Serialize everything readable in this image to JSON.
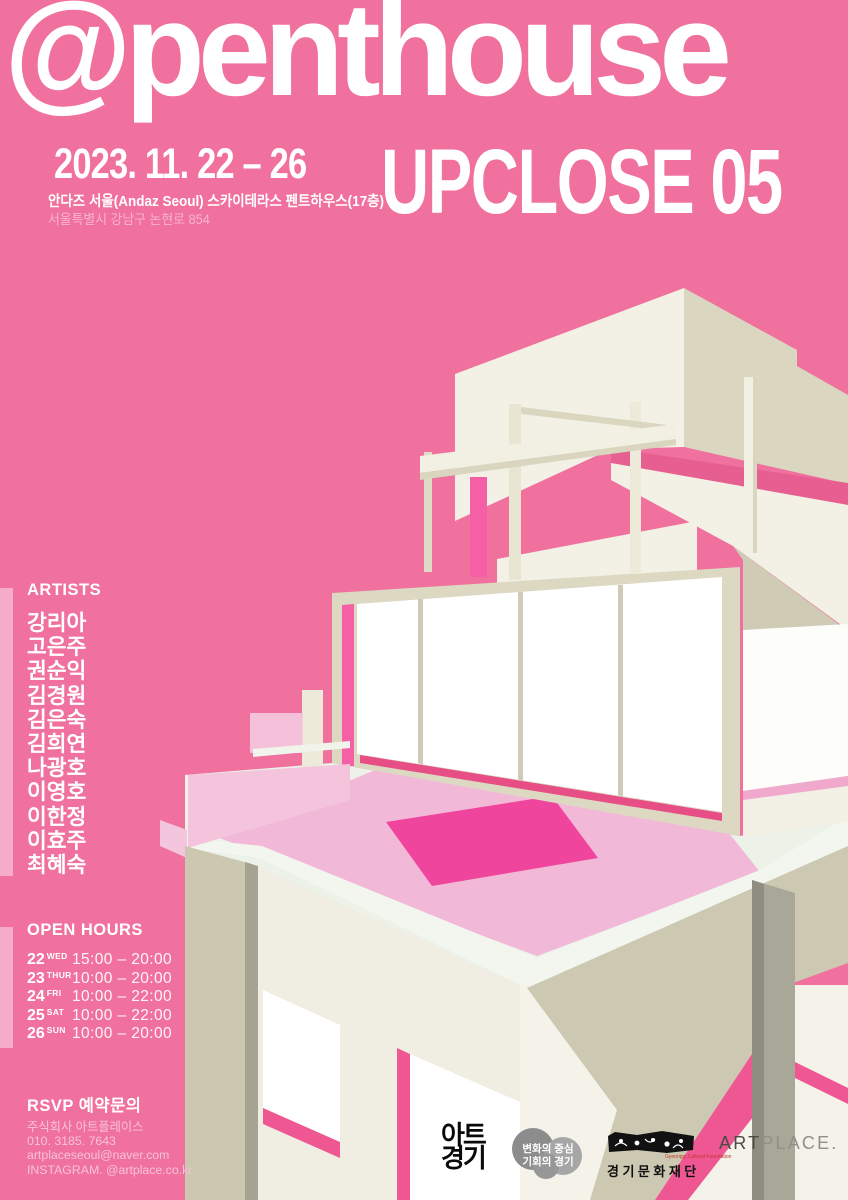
{
  "header": {
    "title": "@penthouse",
    "date": "2023. 11. 22 – 26",
    "upclose": "UPCLOSE 05",
    "venue": "안다즈 서울(Andaz Seoul) 스카이테라스 펜트하우스(17층)",
    "address": "서울특별시 강남구 논현로 854"
  },
  "artists": {
    "heading": "ARTISTS",
    "names": [
      "강리아",
      "고은주",
      "권순익",
      "김경원",
      "김은숙",
      "김희연",
      "나광호",
      "이영호",
      "이한정",
      "이효주",
      "최혜숙"
    ]
  },
  "open_hours": {
    "heading": "OPEN HOURS",
    "rows": [
      {
        "day": "22",
        "dow": "WED",
        "time": "15:00 – 20:00"
      },
      {
        "day": "23",
        "dow": "THUR",
        "time": "10:00 – 20:00"
      },
      {
        "day": "24",
        "dow": "FRI",
        "time": "10:00 – 22:00"
      },
      {
        "day": "25",
        "dow": "SAT",
        "time": "10:00 – 22:00"
      },
      {
        "day": "26",
        "dow": "SUN",
        "time": "10:00 – 20:00"
      }
    ]
  },
  "rsvp": {
    "heading": "RSVP 예약문의",
    "lines": [
      "주식회사 아트플레이스",
      "010. 3185. 7643",
      "artplaceseoul@naver.com",
      "INSTAGRAM. @artplace.co.kr"
    ]
  },
  "footer_logos": {
    "art_gyeonggi": {
      "line1": "아트",
      "line2": "경기"
    },
    "badge": {
      "line1": "변화의 중심",
      "line2": "기회의 경기"
    },
    "gcf": {
      "name": "경기문화재단",
      "sub": "Gyeonggi Cultural Foundation"
    },
    "artplace": {
      "part1": "ART",
      "part2": "PLACE."
    }
  },
  "colors": {
    "background_pink": "#F0709E",
    "accent_rose_stripe": "#E75F90",
    "hot_pink_opening": "#F45FA6",
    "sill_pink": "#E84E86",
    "rug_light_pink": "#F2B8D8",
    "rug_dark_pink": "#F0459C",
    "pale_pink_panel": "#F4C4DD",
    "cream_face": "#F3F1E6",
    "beige_face": "#DAD6BF",
    "khaki_face": "#CCC8B1",
    "column_gray": "#A9A798",
    "text_white": "#FFFFFF",
    "muted_pink_text": "#F6B4D1"
  }
}
